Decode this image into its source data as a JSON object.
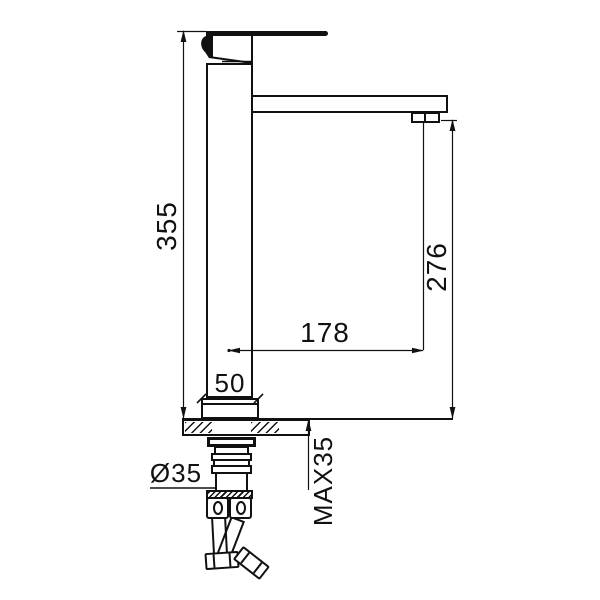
{
  "meta": {
    "background": "#ffffff",
    "line_color": "#111111",
    "drawing_type": "technical dimension drawing",
    "subject": "tall single-lever basin mixer faucet, side elevation with installation dimensions"
  },
  "dimensions": {
    "overall_height": "355",
    "spout_outlet_height": "276",
    "spout_reach": "178",
    "body_base_width": "50",
    "mounting_hole_diameter": "Ø35",
    "max_deck_thickness": "MAX35"
  }
}
